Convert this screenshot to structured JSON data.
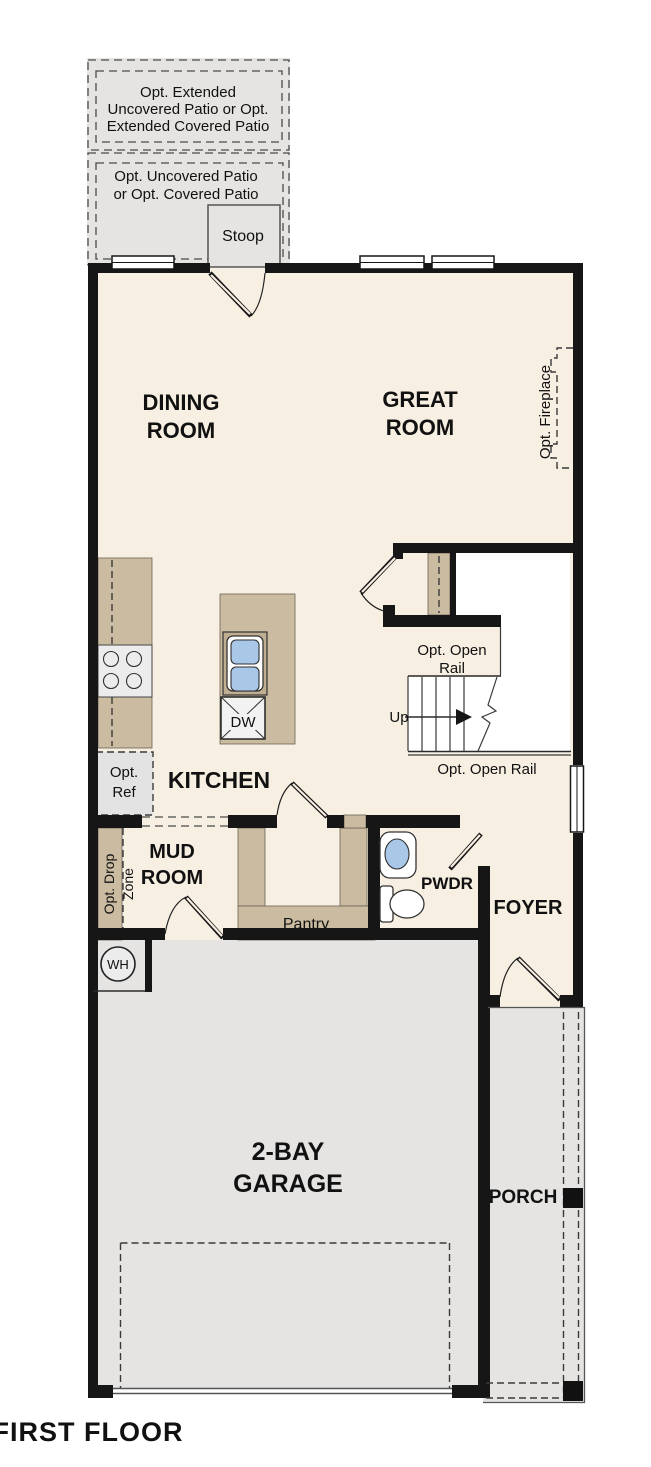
{
  "title": "FIRST FLOOR",
  "colors": {
    "floor": "#f7efe2",
    "hardscape": "#e5e4e2",
    "cabinet_tan": "#cbbca1",
    "wall": "#161616",
    "fixture_blue": "#a9c7e7"
  },
  "labels": {
    "patio_extended": [
      "Opt. Extended",
      "Uncovered Patio or Opt.",
      "Extended Covered Patio"
    ],
    "patio": [
      "Opt. Uncovered Patio",
      "or Opt. Covered Patio"
    ],
    "stoop": "Stoop",
    "dining_room": [
      "DINING",
      "ROOM"
    ],
    "great_room": [
      "GREAT",
      "ROOM"
    ],
    "opt_fireplace": "Opt. Fireplace",
    "opt_open_rail_upper": [
      "Opt. Open",
      "Rail"
    ],
    "up": "Up",
    "opt_open_rail_lower": "Opt. Open Rail",
    "kitchen": "KITCHEN",
    "dw": "DW",
    "opt_ref": [
      "Opt.",
      "Ref"
    ],
    "opt_drop_zone": [
      "Opt. Drop",
      "Zone"
    ],
    "mud_room": [
      "MUD",
      "ROOM"
    ],
    "pantry": "Pantry",
    "pwdr": "PWDR",
    "foyer": "FOYER",
    "wh": "WH",
    "garage": [
      "2-BAY",
      "GARAGE"
    ],
    "porch": "PORCH"
  }
}
